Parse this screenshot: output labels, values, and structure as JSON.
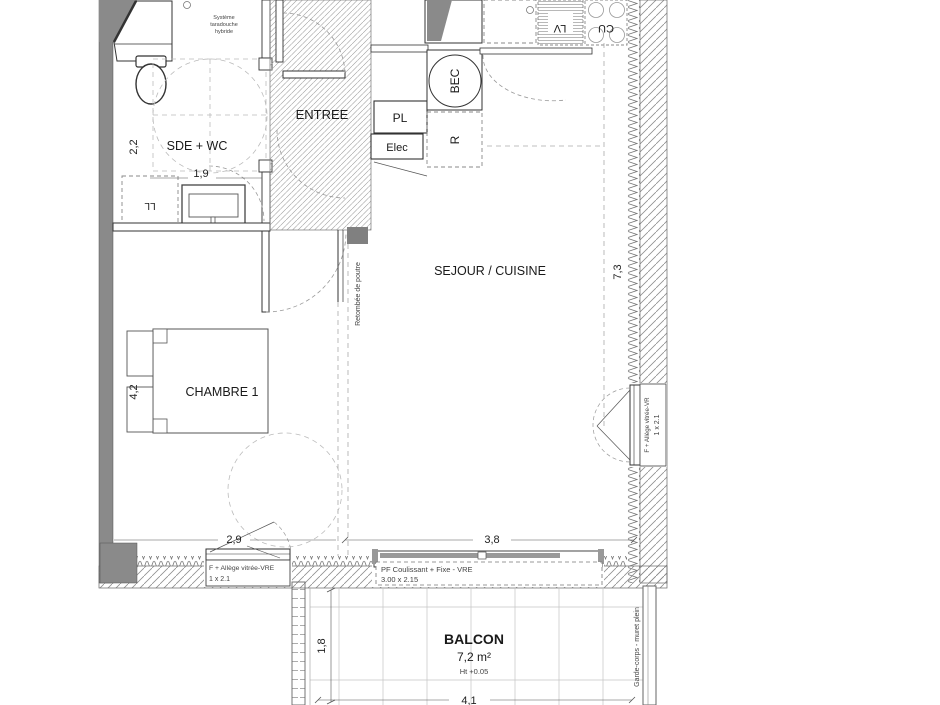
{
  "rooms": {
    "sde_wc": "SDE + WC",
    "entree": "ENTREE",
    "sejour": "SEJOUR / CUISINE",
    "chambre": "CHAMBRE 1",
    "balcon": "BALCON",
    "balcon_area": "7,2 m²",
    "balcon_height": "Ht +0.05"
  },
  "equipment": {
    "placard": "PL",
    "elec": "Elec",
    "water_heater": "BEC",
    "refrigerator": "R",
    "dishwasher": "LV",
    "cooktop": "CU",
    "washing_machine": "LL",
    "note_line1": "Système",
    "note_line2": "taradouche",
    "note_line3": "hybride",
    "beam_note": "Retombée de poutre",
    "railing_note": "Garde-corps - muret plein"
  },
  "dimensions": {
    "sde_width": "2,2",
    "sde_depth": "1,9",
    "chambre_height": "4,2",
    "chambre_width": "2,9",
    "sejour_width": "3,8",
    "sejour_height": "7,3",
    "balcon_depth": "1,8",
    "balcon_width": "4,1"
  },
  "windows": {
    "chambre_window_line1": "F + Allège vitrée-VRE",
    "chambre_window_line2": "1 x 2.1",
    "bay_window_line1": "PF Coulissant + Fixe - VRE",
    "bay_window_line2": "3.00 x 2.15",
    "sejour_window_line1": "F + Allège vitrée-VR",
    "sejour_window_line2": "1 x 2.1"
  },
  "colors": {
    "wall_fill": "#8a8a8a",
    "line": "#333333",
    "dash": "#999999"
  }
}
